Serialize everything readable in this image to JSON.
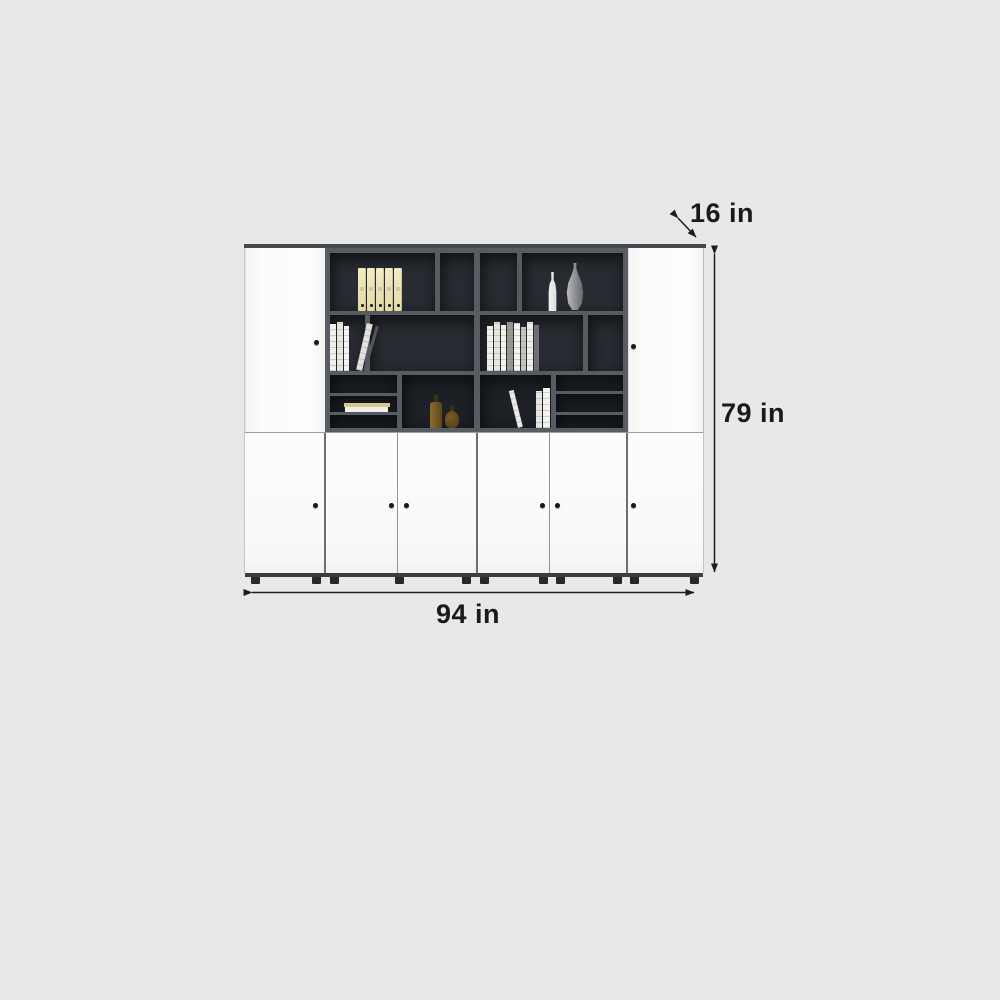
{
  "diagram": {
    "dimension_labels": {
      "depth": "16 in",
      "height": "79 in",
      "width": "94 in"
    }
  },
  "icons": {
    "depth_arrow": "double-headed-diagonal-arrow",
    "height_arrow": "double-headed-vertical-arrow",
    "width_arrow": "double-headed-horizontal-arrow"
  },
  "colors": {
    "background": "#e8e8e8",
    "annotation_ink": "#1c1d1f",
    "cabinet_door_white": "#fbfbfb",
    "shelf_frame_gray": "#575c63",
    "shelf_interior_dark": "#23262b",
    "binder_cream": "#ece4b6",
    "bottle_amber": "#7c5b26"
  }
}
